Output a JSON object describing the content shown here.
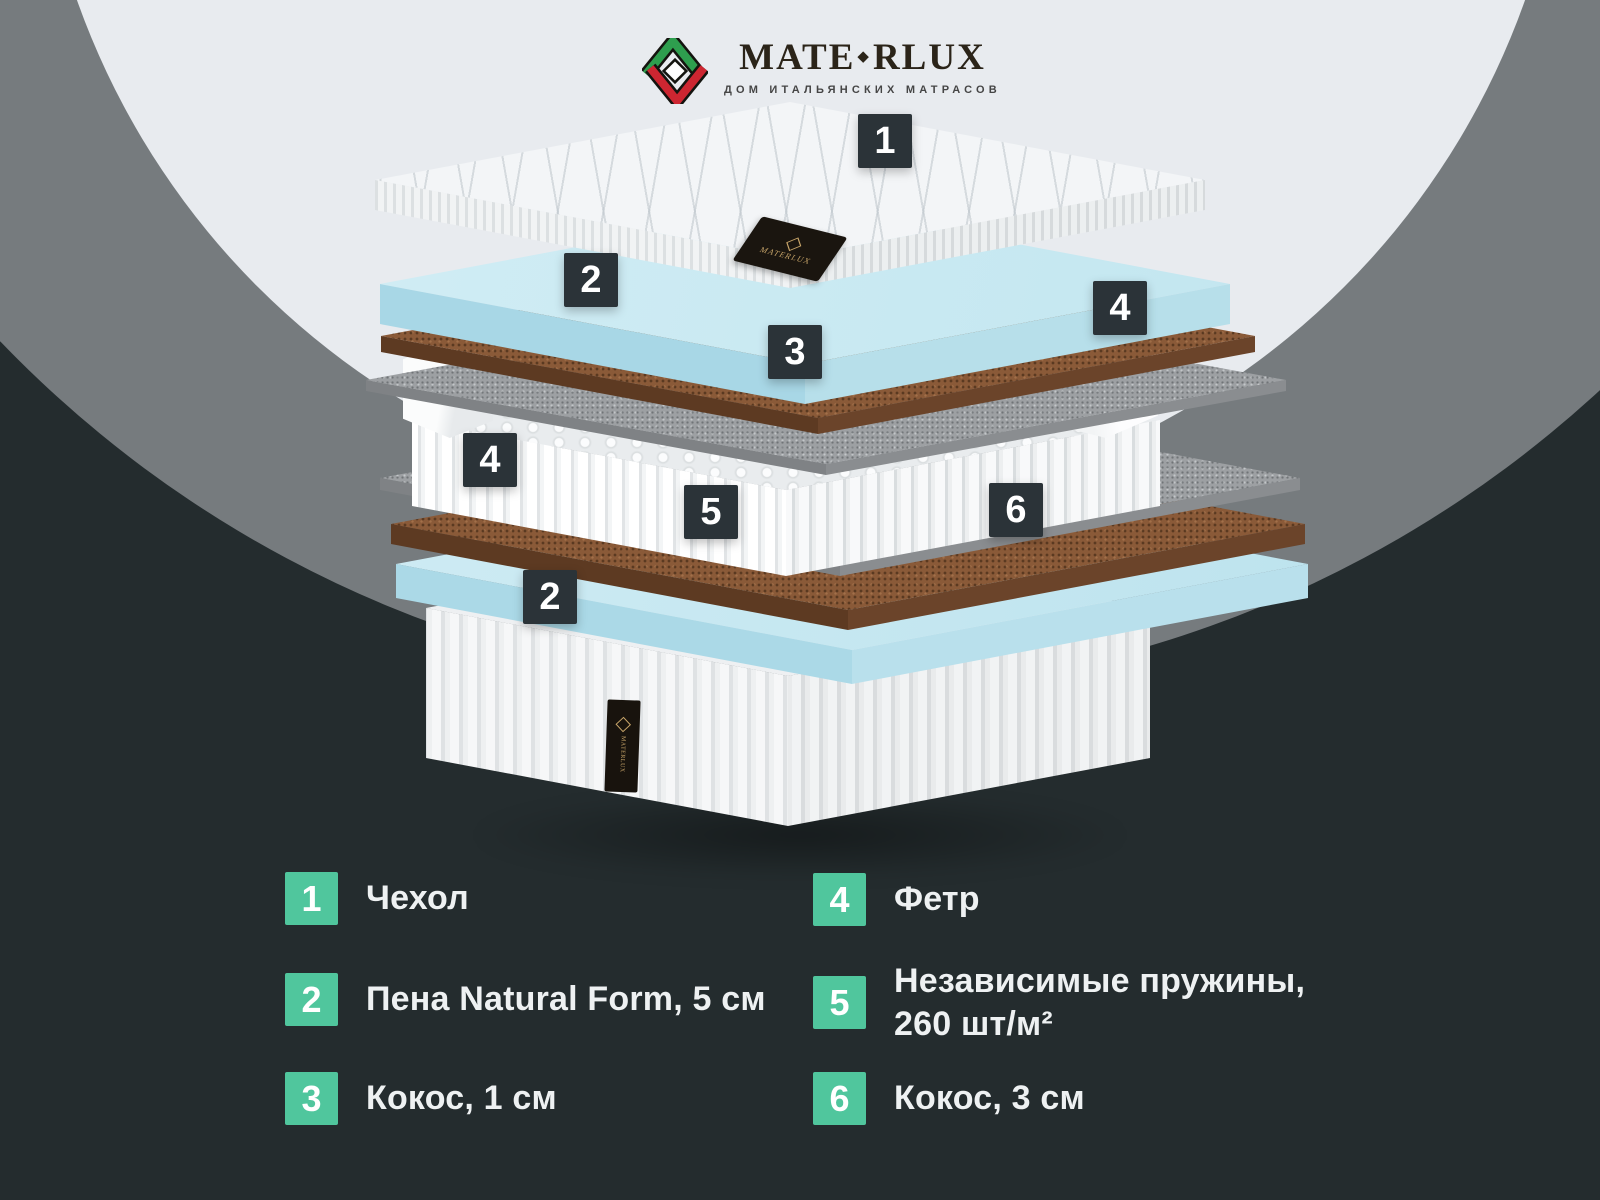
{
  "brand": {
    "wordmark_left": "MATE",
    "wordmark_diamond": "◆",
    "wordmark_right": "RLUX",
    "tagline": "ДОМ ИТАЛЬЯНСКИХ МАТРАСОВ"
  },
  "colors": {
    "background": "#242c2e",
    "circle_gray": "#767b7e",
    "circle_light": "#e8ebef",
    "accent_teal": "#50c69d",
    "marker_dark": "#2b3338",
    "foam_blue": "#c9e9f2",
    "coco_brown": "#8a5a38",
    "felt_gray": "#9da0a3",
    "logo_green": "#2e9e4e",
    "logo_red": "#cd2631",
    "tag_gold": "#c9a66a"
  },
  "diagram": {
    "markers": [
      {
        "id": "marker-1-cover",
        "num": "1"
      },
      {
        "id": "marker-2-foam-top",
        "num": "2"
      },
      {
        "id": "marker-3-coco-thin",
        "num": "3"
      },
      {
        "id": "marker-4-felt-right",
        "num": "4"
      },
      {
        "id": "marker-4-felt-left",
        "num": "4"
      },
      {
        "id": "marker-5-springs",
        "num": "5"
      },
      {
        "id": "marker-6-coco-thick",
        "num": "6"
      },
      {
        "id": "marker-2-foam-bottom",
        "num": "2"
      }
    ],
    "tags": {
      "top_tag_text": "MATERLUX",
      "bottom_tag_text": "MATERLUX"
    }
  },
  "legend": {
    "items": [
      {
        "num": "1",
        "label": "Чехол",
        "label2": ""
      },
      {
        "num": "2",
        "label": "Пена Natural Form, 5 см",
        "label2": ""
      },
      {
        "num": "3",
        "label": "Кокос, 1 см",
        "label2": ""
      },
      {
        "num": "4",
        "label": "Фетр",
        "label2": ""
      },
      {
        "num": "5",
        "label": "Независимые пружины,",
        "label2": "260 шт/м²"
      },
      {
        "num": "6",
        "label": "Кокос, 3 см",
        "label2": ""
      }
    ]
  }
}
